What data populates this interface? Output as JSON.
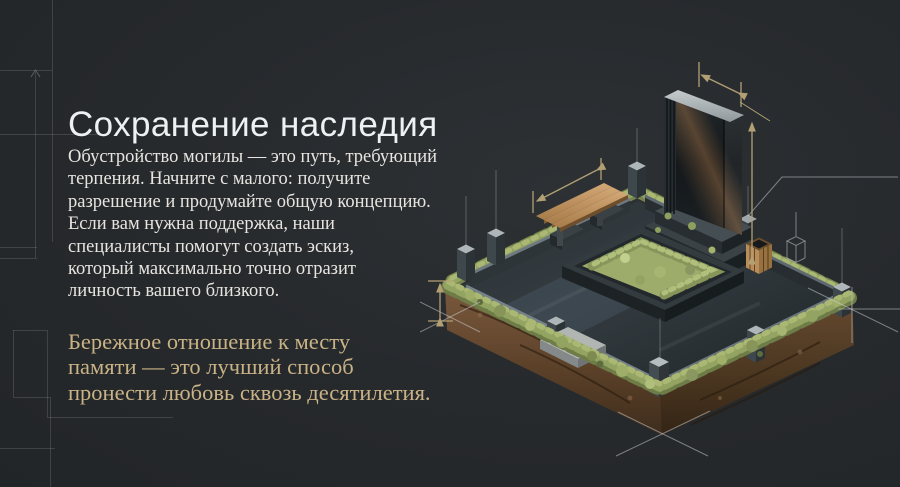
{
  "slide": {
    "heading": "Сохранение наследия",
    "paragraph_lines": [
      "Обустройство могилы — это путь, требующий",
      "терпения. Начните с малого: получите",
      "разрешение и продумайте общую концепцию.",
      "Если вам нужна поддержка, наши",
      "специалисты помогут создать эскиз,",
      "который максимально точно отразит",
      "личность вашего близкого."
    ],
    "paragraph_text": "Обустройство могилы — это путь, требующий терпения. Начните с малого: получите разрешение и продумайте общую концепцию. Если вам нужна поддержка, наши специалисты помогут создать эскиз, который максимально точно отразит личность вашего близкого.",
    "quote_lines": [
      "Бережное отношение к месту",
      "памяти — это лучший способ",
      "пронести любовь сквозь десятилетия."
    ],
    "quote_text": "Бережное отношение к месту памяти — это лучший способ пронести любовь сквозь десятилетия."
  },
  "illustration": {
    "description": "Изометрическая 3D-иллюстрация благоустроенного места захоронения с чертёжными размерными линиями",
    "elements": [
      "гранитная стела",
      "цоколь памятника",
      "ограда со столбиками",
      "деревянная скамейка",
      "цветник с мхом",
      "деревянная ваза",
      "газон",
      "срез грунта",
      "размерные линии",
      "чертёжные перекрестия"
    ]
  },
  "colors": {
    "background": "#272a2d",
    "heading_text": "#eef1f2",
    "body_text": "#e8e5e0",
    "accent_gold_text": "#c9b286",
    "dimension_gold": "#b2a074",
    "blueprint_line": "#b9bec2",
    "moss_green": "#93a362",
    "soil_brown": "#6b4e36",
    "granite_dark": "#2a3135",
    "granite_light": "#b9bfc2",
    "wood": "#c49a68"
  }
}
